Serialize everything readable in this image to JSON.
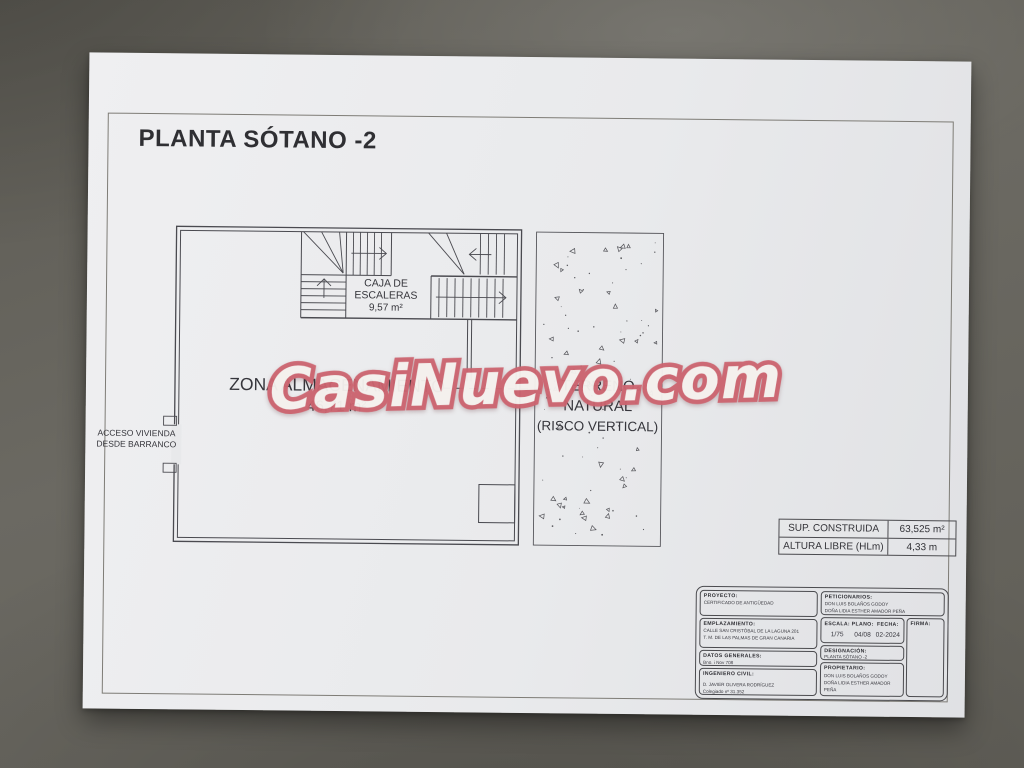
{
  "drawing": {
    "title": "PLANTA SÓTANO -2",
    "watermark": "CasiNuevo.com",
    "rooms": {
      "stairs": {
        "label_line1": "CAJA DE",
        "label_line2": "ESCALERAS",
        "area": "9,57 m²"
      },
      "storage": {
        "label": "ZONA ALMACENAMIENTO",
        "area": "46,71 m²"
      },
      "terrain": {
        "line1": "TERRENO",
        "line2": "NATURAL",
        "line3": "(RISCO VERTICAL)"
      },
      "access": {
        "line1": "ACCESO VIVIENDA",
        "line2": "DESDE BARRANCO"
      }
    },
    "area_table": {
      "rows": [
        {
          "label": "SUP. CONSTRUIDA",
          "value": "63,525 m²"
        },
        {
          "label": "ALTURA LIBRE (HLm)",
          "value": "4,33 m"
        }
      ]
    },
    "title_block": {
      "proyecto": {
        "label": "PROYECTO:",
        "value": "CERTIFICADO DE ANTIGÜEDAD"
      },
      "emplazamiento": {
        "label": "EMPLAZAMIENTO:",
        "line1": "CALLE SAN CRISTÓBAL DE LA LAGUNA 201",
        "line2": "T. M. DE LAS PALMAS DE GRAN CANARIA"
      },
      "datos": {
        "label": "DATOS GENERALES:",
        "value": "Bno. i Nov 708"
      },
      "ingeniero": {
        "label": "INGENIERO CIVIL:",
        "line1": "D. JAVIER OLIVERA RODRÍGUEZ",
        "line2": "Colegiado nº 31.352"
      },
      "peticionarios": {
        "label": "PETICIONARIOS:",
        "line1": "DON LUIS BOLAÑOS GODOY",
        "line2": "DOÑA LIDIA ESTHER AMADOR PEÑA"
      },
      "escala": {
        "label": "ESCALA:",
        "value": "1/75"
      },
      "plano": {
        "label": "PLANO:",
        "value": "04/08"
      },
      "fecha": {
        "label": "FECHA:",
        "value": "02-2024"
      },
      "firma": {
        "label": "FIRMA:"
      },
      "designacion": {
        "label": "DESIGNACIÓN:",
        "value": "PLANTA SÓTANO -2"
      },
      "propietario": {
        "label": "PROPIETARIO:",
        "line1": "DON LUIS BOLAÑOS GODOY",
        "line2": "DOÑA LIDIA ESTHER AMADOR PEÑA"
      }
    }
  },
  "colors": {
    "background": "#64625c",
    "paper": "#e9eaec",
    "ink": "#45454a",
    "watermark_fill": "#f7f4f1",
    "watermark_outline": "#cd6570"
  }
}
